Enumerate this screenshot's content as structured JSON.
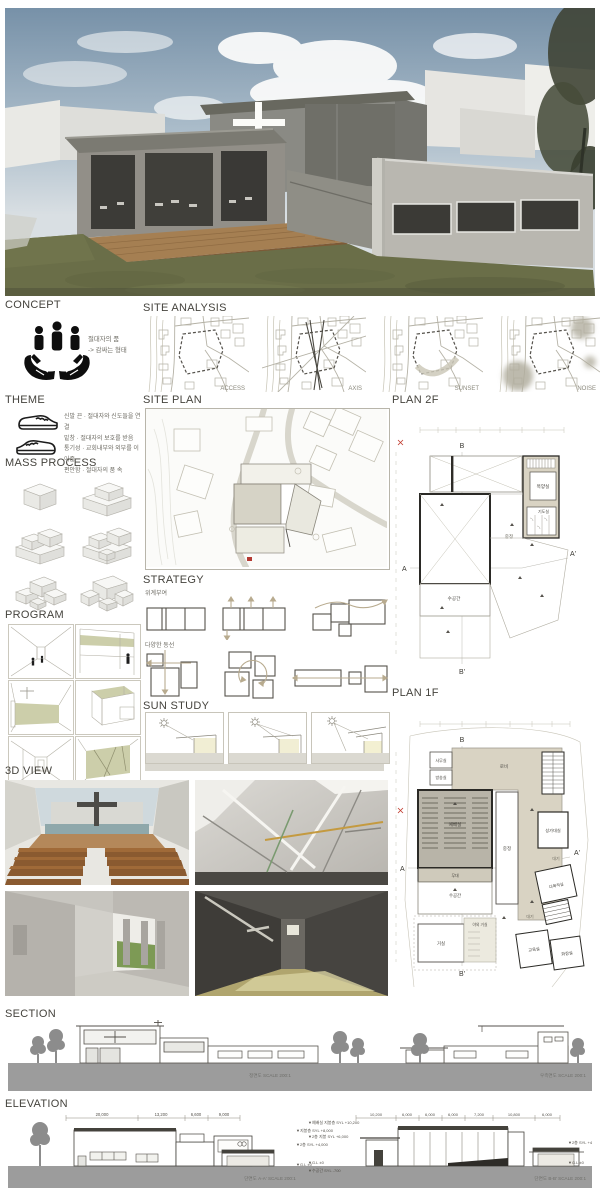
{
  "headings": {
    "concept": "CONCEPT",
    "site_analysis": "SITE ANALYSIS",
    "theme": "THEME",
    "site_plan": "SITE PLAN",
    "plan_2f": "PLAN 2F",
    "mass_process": "MASS PROCESS",
    "strategy": "STRATEGY",
    "program": "PROGRAM",
    "sun_study": "SUN STUDY",
    "plan_1f": "PLAN 1F",
    "view_3d": "3D VIEW",
    "section": "SECTION",
    "elevation": "ELEVATION"
  },
  "concept": {
    "caption_line1": "절대자의 품",
    "caption_line2": "-> 감싸는 형태"
  },
  "site_analysis": {
    "labels": [
      "ACCESS",
      "AXIS",
      "SUNSET",
      "NOISE"
    ]
  },
  "theme": {
    "lines": [
      "신발 끈 · 절대자와 신도들을 연결",
      "밑창 · 절대자의 보호를 받음",
      "통기성 · 교회내부와 외부를 이어줌",
      "편안함 · 절대자의 품 속"
    ]
  },
  "strategy": {
    "sub1": "위계부여",
    "sub2": "다양한 동선"
  },
  "plan_2f": {
    "markers": {
      "a": "A",
      "a2": "A'",
      "b": "B",
      "b2": "B'"
    },
    "rooms": {
      "pastor": "목양실",
      "prayer": "기도실",
      "courtyard": "중정",
      "water": "수공간"
    }
  },
  "plan_1f": {
    "markers": {
      "a": "A",
      "a2": "A'",
      "b": "B",
      "b2": "B'"
    },
    "rooms": {
      "office": "사무실",
      "broadcast": "방송실",
      "lobby": "로비",
      "worship": "예배실",
      "stage": "무대",
      "water": "수공간",
      "living": "거실",
      "outdoor": "야외 거실",
      "courtyard": "중정",
      "choir": "성가대실",
      "waiting1": "대기",
      "multi": "다목적실",
      "waiting2": "대기",
      "edu": "교육실",
      "toilet": "화장실"
    }
  },
  "section": {
    "caption_left": "정면도  SCALE 200:1",
    "caption_right": "우측면도  SCALE 200:1"
  },
  "elevation": {
    "dims_left": [
      "20,000",
      "13,200",
      "6,600",
      "9,000"
    ],
    "dims_right": [
      "10,200",
      "6,000",
      "6,000",
      "6,000",
      "7,200",
      "10,800",
      "6,000"
    ],
    "levels_left": [
      "▼지붕층 SYL +8,000",
      "▼2층 SYL +4,000",
      "▼G.L ±0"
    ],
    "levels_right": [
      "▼예배실 지붕층 SYL +10,200",
      "▼2층 지붕 SYL +6,000",
      "▼G.L ±0",
      "▼수공간 SYL -700"
    ],
    "levels_far_right": [
      "▼2층 SYL +4,000",
      "▼G.L ±0"
    ],
    "caption_left": "단면도 A-A'  SCALE 200:1",
    "caption_right": "단면도 B-B'  SCALE 200:1"
  },
  "colors": {
    "beige": "#d9d3c3",
    "olive": "#c9cba8",
    "ground": "#9c9c9c",
    "accent_red": "#b43a32"
  }
}
